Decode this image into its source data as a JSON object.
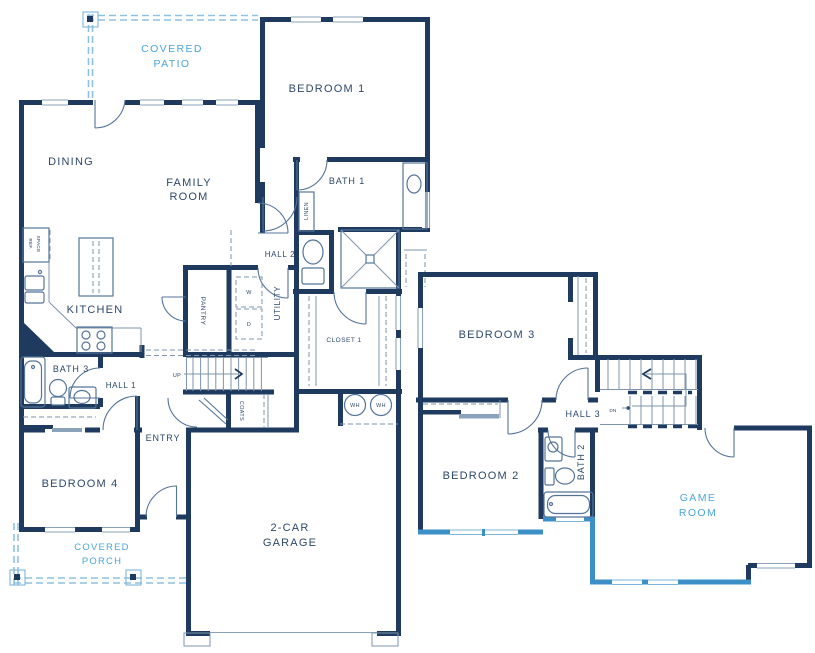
{
  "floor1": {
    "patio_l1": "COVERED",
    "patio_l2": "PATIO",
    "dining": "DINING",
    "family_l1": "FAMILY",
    "family_l2": "ROOM",
    "bedroom1": "BEDROOM 1",
    "bath1": "BATH 1",
    "linen": "LINEN",
    "hall2": "HALL 2",
    "kitchen": "KITCHEN",
    "ref_l1": "REF.",
    "ref_l2": "SPACE",
    "pantry": "PANTRY",
    "utility": "UTILITY",
    "washer": "W",
    "dryer": "D",
    "closet1": "CLOSET 1",
    "bath3": "BATH 3",
    "hall1": "HALL 1",
    "up": "UP",
    "coats": "COATS",
    "entry": "ENTRY",
    "bedroom4": "BEDROOM 4",
    "porch_l1": "COVERED",
    "porch_l2": "PORCH",
    "garage_l1": "2-CAR",
    "garage_l2": "GARAGE",
    "water_heater": "WH"
  },
  "floor2": {
    "bedroom3": "BEDROOM 3",
    "hall3": "HALL 3",
    "down": "DN",
    "bedroom2": "BEDROOM 2",
    "bath2": "BATH 2",
    "game_l1": "GAME",
    "game_l2": "ROOM"
  },
  "colors": {
    "wall": "#1e3a5f",
    "label": "#2c486a",
    "accent_blue": "#4aa6d9",
    "optional_wall": "#3d8fc7"
  }
}
